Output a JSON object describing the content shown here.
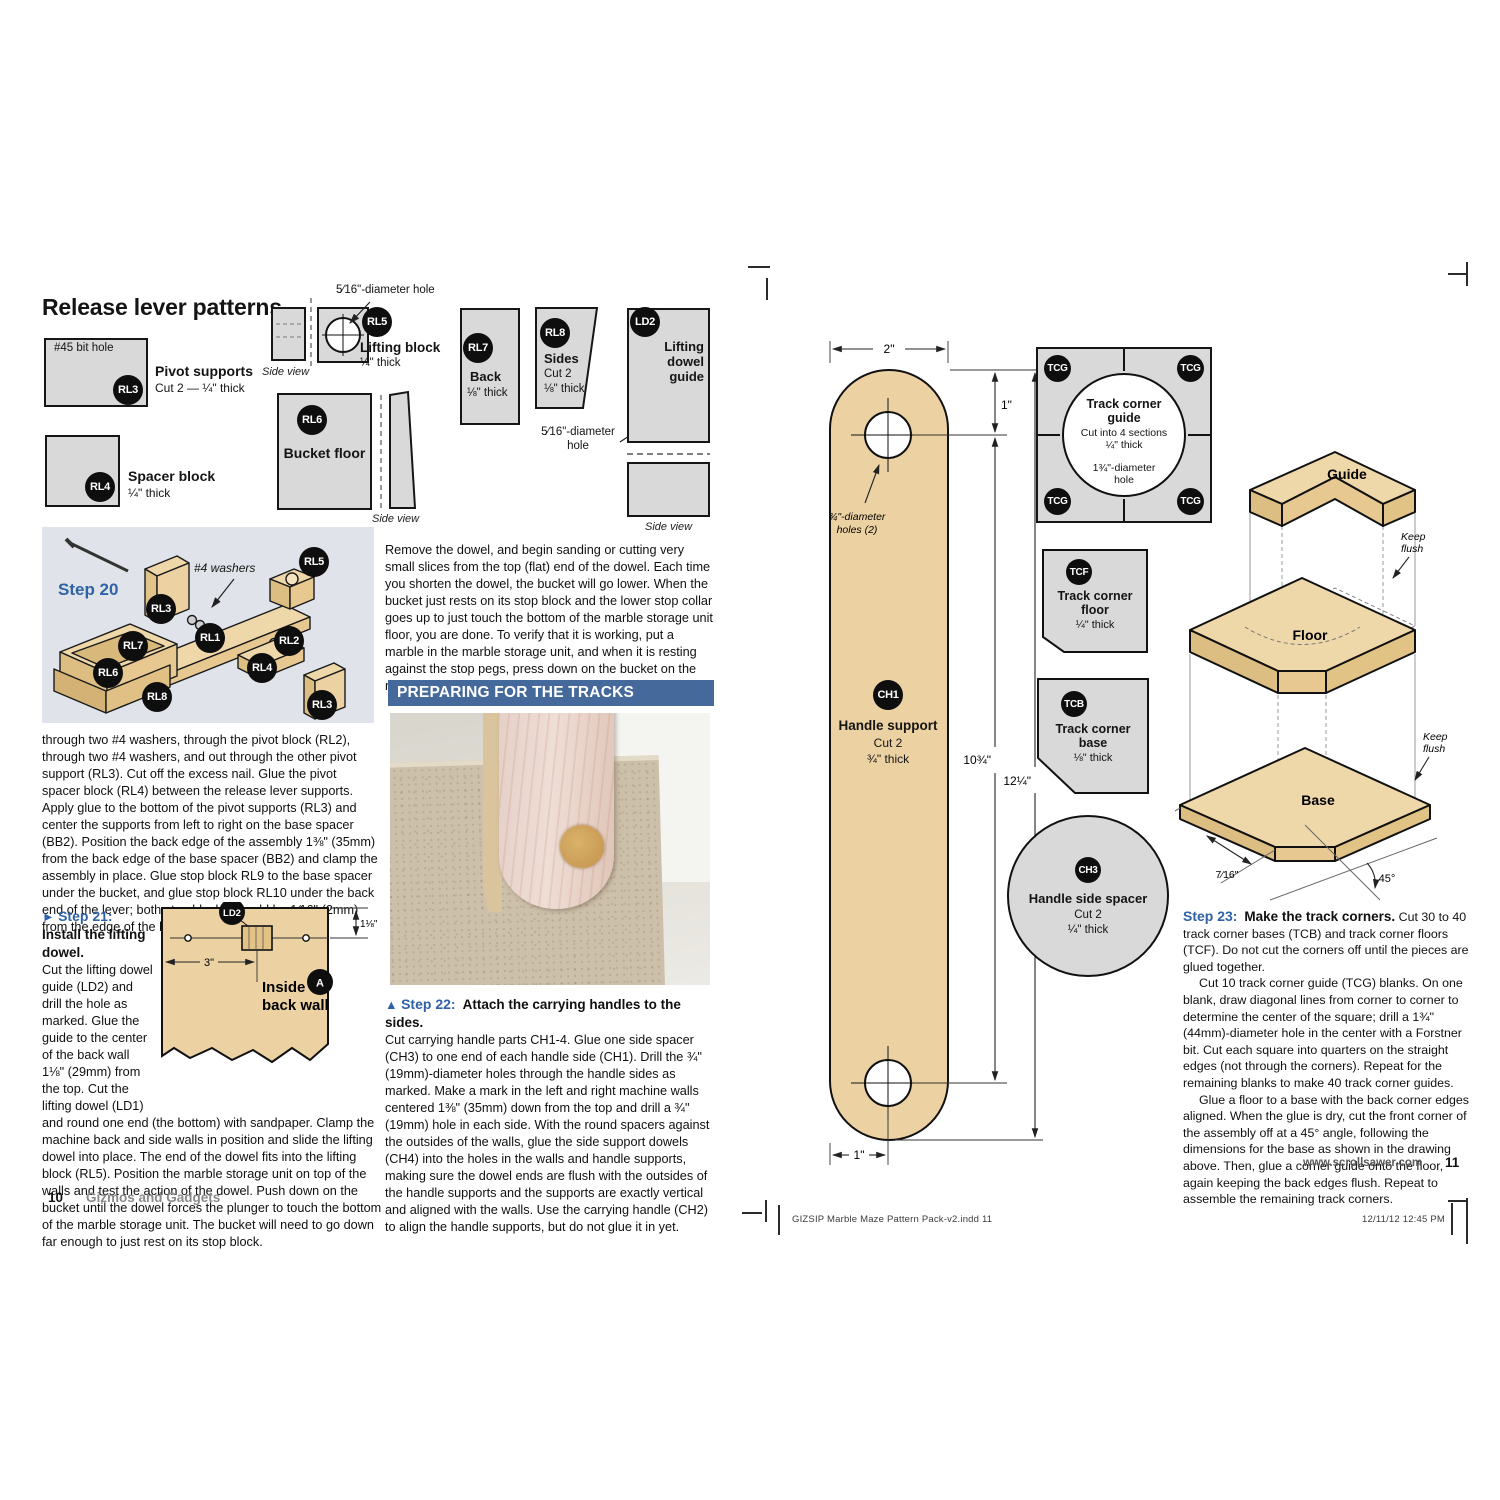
{
  "colors": {
    "accent_blue": "#2f62a7",
    "banner_blue": "#46699c",
    "wood_tan": "#ecd2a2",
    "pattern_grey": "#d9d9d9"
  },
  "left": {
    "heading": "Release lever patterns",
    "rl3": {
      "badge": "RL3",
      "hole": "#45 bit hole",
      "name": "Pivot supports",
      "spec": "Cut 2 — ¼\" thick"
    },
    "rl4": {
      "badge": "RL4",
      "name": "Spacer block",
      "spec": "¼\" thick"
    },
    "rl5": {
      "badge": "RL5",
      "hole": "5⁄16\"-diameter hole",
      "name": "Lifting block",
      "spec": "¼\" thick",
      "side": "Side view"
    },
    "rl6": {
      "badge": "RL6",
      "name": "Bucket floor",
      "side": "Side view"
    },
    "rl7": {
      "badge": "RL7",
      "name": "Back",
      "spec": "⅛\" thick"
    },
    "rl8": {
      "badge": "RL8",
      "name": "Sides",
      "spec1": "Cut 2",
      "spec2": "⅛\" thick"
    },
    "ld2": {
      "badge": "LD2",
      "name": "Lifting dowel guide",
      "hole1": "5⁄16\"-diameter",
      "hole2": "hole",
      "side": "Side view"
    },
    "step20": {
      "label": "Step 20",
      "washers": "#4 washers",
      "badges": [
        "RL5",
        "RL3",
        "RL1",
        "RL2",
        "RL7",
        "RL6",
        "RL4",
        "RL8",
        "RL3"
      ]
    },
    "para1": "through two #4 washers, through the pivot block (RL2), through two #4 washers, and out through the other pivot support (RL3). Cut off the excess nail. Glue the pivot spacer block (RL4) between the release lever supports. Apply glue to the bottom of the pivot supports (RL3) and center the supports from left to right on the base spacer (BB2). Position the back edge of the assembly 1⅜\" (35mm) from the back edge of the base spacer (BB2) and clamp the assembly in place. Glue stop block RL9 to the base spacer under the bucket, and glue stop block RL10 under the back end of the lever; both stop blocks should be 1⁄16\" (2mm) from the edge of the base spacer.",
    "step21": {
      "marker": "►",
      "title": "Step 21:",
      "subtitle": "Install the lifting dowel.",
      "body": "Cut the lifting dowel guide (LD2) and drill the hole as marked. Glue the guide to the center of the back wall 1⅛\" (29mm) from the top. Cut the lifting dowel (LD1) and round one end (the bottom) with sandpaper. Clamp the machine back and side walls in position and slide the lifting dowel into place. The end of the dowel fits into the lifting block (RL5). Position the marble storage unit on top of the walls and test the action of the dowel. Push down on the bucket until the dowel forces the plunger to touch the bottom of the marble storage unit. The bucket will need to go down far enough to just rest on its stop block.",
      "fig": {
        "badge": "LD2",
        "dim_height": "1⅛\"",
        "dim_width": "3\"",
        "label1": "Inside",
        "label2": "back wall",
        "a_badge": "A"
      }
    },
    "footer": {
      "page": "10",
      "magazine": "Gizmos and Gadgets"
    }
  },
  "middle": {
    "para": "Remove the dowel, and begin sanding or cutting very small slices from the top (flat) end of the dowel. Each time you shorten the dowel, the bucket will go lower. When the bucket just rests on its stop block and the lower stop collar goes up to just touch the bottom of the marble storage unit floor, you are done. To verify that it is working, put a marble in the marble storage unit, and when it is resting against the stop pegs, press down on the bucket on the release lever. This should release the marble.",
    "banner": "PREPARING FOR THE TRACKS",
    "step22": {
      "marker": "▲",
      "title": "Step 22:",
      "subtitle": "Attach the carrying handles to the sides.",
      "body": "Cut carrying handle parts CH1-4. Glue one side spacer (CH3) to one end of each handle side (CH1). Drill the ¾\" (19mm)-diameter holes through the handle sides as marked. Make a mark in the left and right machine walls centered 1⅜\" (35mm) down from the top and drill a ¾\" (19mm) hole in each side. With the round spacers against the outsides of the walls, glue the side support dowels (CH4) into the holes in the walls and handle supports, making sure the dowel ends are flush with the outsides of the handle supports and the supports are exactly vertical and aligned with the walls. Use the carrying handle (CH2) to align the handle supports, but do not glue it in yet."
    }
  },
  "right": {
    "ch1": {
      "badge": "CH1",
      "name": "Handle support",
      "cut": "Cut 2",
      "thick": "¾\" thick",
      "dim_top": "2\"",
      "dim_upper": "1\"",
      "dim_inner": "10¾\"",
      "dim_outer": "12¼\"",
      "dim_bottom": "1\"",
      "holes1": "¾\"-diameter",
      "holes2": "holes (2)"
    },
    "tcg": {
      "badge": "TCG",
      "name1": "Track corner",
      "name2": "guide",
      "spec1": "Cut into 4 sections",
      "spec2": "¼\" thick",
      "hole1": "1¾\"-diameter",
      "hole2": "hole"
    },
    "tcf": {
      "badge": "TCF",
      "name1": "Track corner",
      "name2": "floor",
      "spec": "¼\" thick"
    },
    "tcb": {
      "badge": "TCB",
      "name1": "Track corner",
      "name2": "base",
      "spec": "⅛\" thick"
    },
    "ch3": {
      "badge": "CH3",
      "name": "Handle side spacer",
      "cut": "Cut 2",
      "thick": "¼\" thick"
    },
    "iso": {
      "guide": "Guide",
      "floor": "Floor",
      "base": "Base",
      "flush1": "Keep",
      "flush2": "flush",
      "dim_cut": "7⁄16\"",
      "dim_angle": "45°"
    },
    "step23": {
      "title": "Step 23:",
      "subtitle": "Make the track corners.",
      "p1": "Cut 30 to 40 track corner bases (TCB) and track corner floors (TCF). Do not cut the corners off until the pieces are glued together.",
      "p2": "Cut 10 track corner guide (TCG)  blanks. On one blank, draw diagonal lines from corner to corner to determine the center of the square; drill a 1¾\" (44mm)-diameter hole in the center with a Forstner bit. Cut each square into quarters on the straight edges (not through the corners). Repeat for the remaining blanks to make 40 track corner guides.",
      "p3": "Glue a floor to a base with the back corner edges aligned. When the glue is dry, cut the front corner of the assembly off at a 45° angle, following the dimensions for the base as shown in the drawing above. Then, glue a corner guide onto the floor, again keeping the back edges flush. Repeat to assemble the remaining track corners."
    },
    "footer": {
      "url": "www.scrollsawer.com",
      "page": "11"
    }
  },
  "print": {
    "slug": "GIZSIP Marble Maze Pattern Pack-v2.indd    11",
    "timestamp": "12/11/12    12:45 PM"
  }
}
